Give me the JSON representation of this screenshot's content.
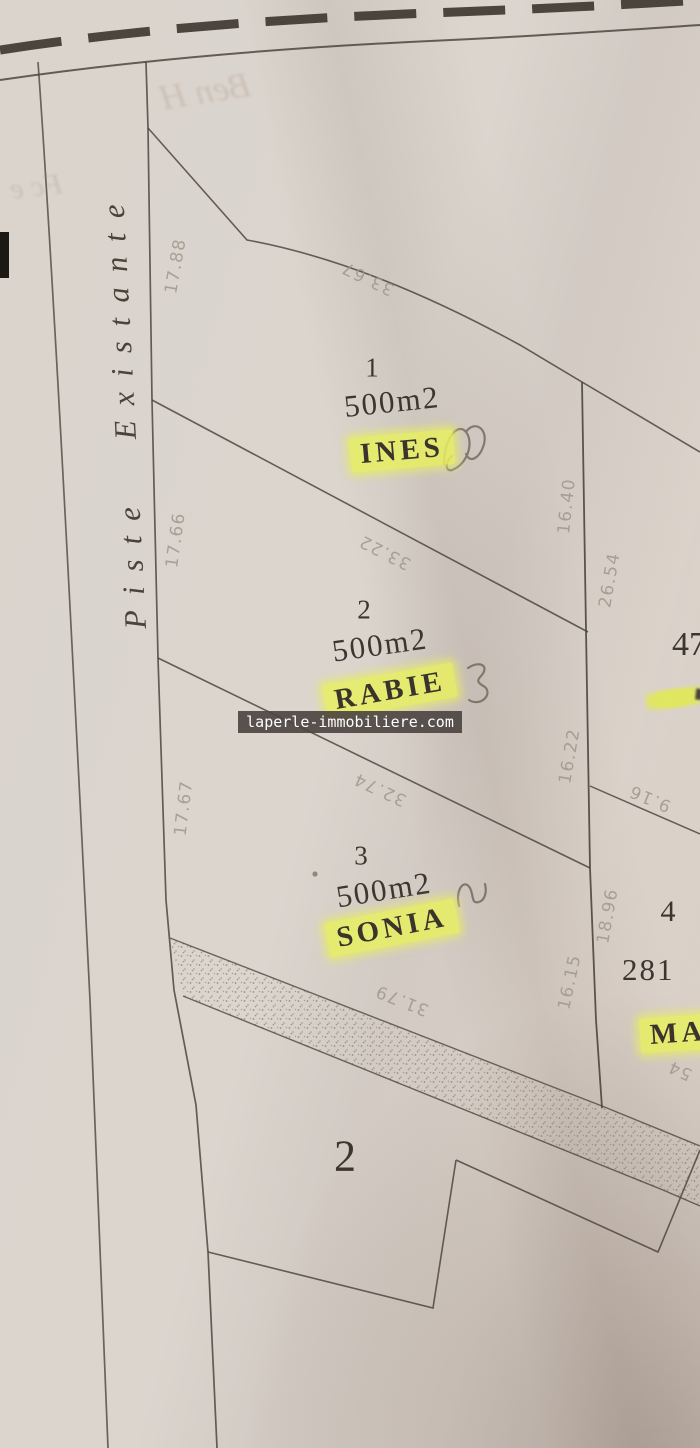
{
  "road": {
    "label": "Piste Existante"
  },
  "watermark": {
    "text": "laperle-immobiliere.com",
    "bg_color": "#4a423f",
    "text_color": "#ffffff"
  },
  "plots": {
    "p1": {
      "number": "1",
      "area": "500m2",
      "name": "INES"
    },
    "p2": {
      "number": "2",
      "area": "500m2",
      "name": "RABIE"
    },
    "p3": {
      "number": "3",
      "area": "500m2",
      "name": "SONIA"
    },
    "p4": {
      "number": "4",
      "area_partial": "281",
      "name_partial": "MA"
    },
    "p47": {
      "number_partial": "47"
    }
  },
  "outside_parcel": {
    "number": "2"
  },
  "measurements": [
    {
      "value": "17.88"
    },
    {
      "value": "17.66"
    },
    {
      "value": "17.67"
    },
    {
      "value": "33.67"
    },
    {
      "value": "33.22"
    },
    {
      "value": "32.74"
    },
    {
      "value": "31.79"
    },
    {
      "value": "16.40"
    },
    {
      "value": "16.22"
    },
    {
      "value": "16.15"
    },
    {
      "value": "26.54"
    },
    {
      "value": "9.16"
    },
    {
      "value": "18.96"
    },
    {
      "value": "54"
    }
  ],
  "bleedthrough": {
    "line1": "Ben H",
    "line2": "Fc e"
  },
  "colors": {
    "paper": "#d8d2cb",
    "ink": "#4c463f",
    "faded_ink": "#a0978c",
    "highlight": "#e8ee60"
  }
}
